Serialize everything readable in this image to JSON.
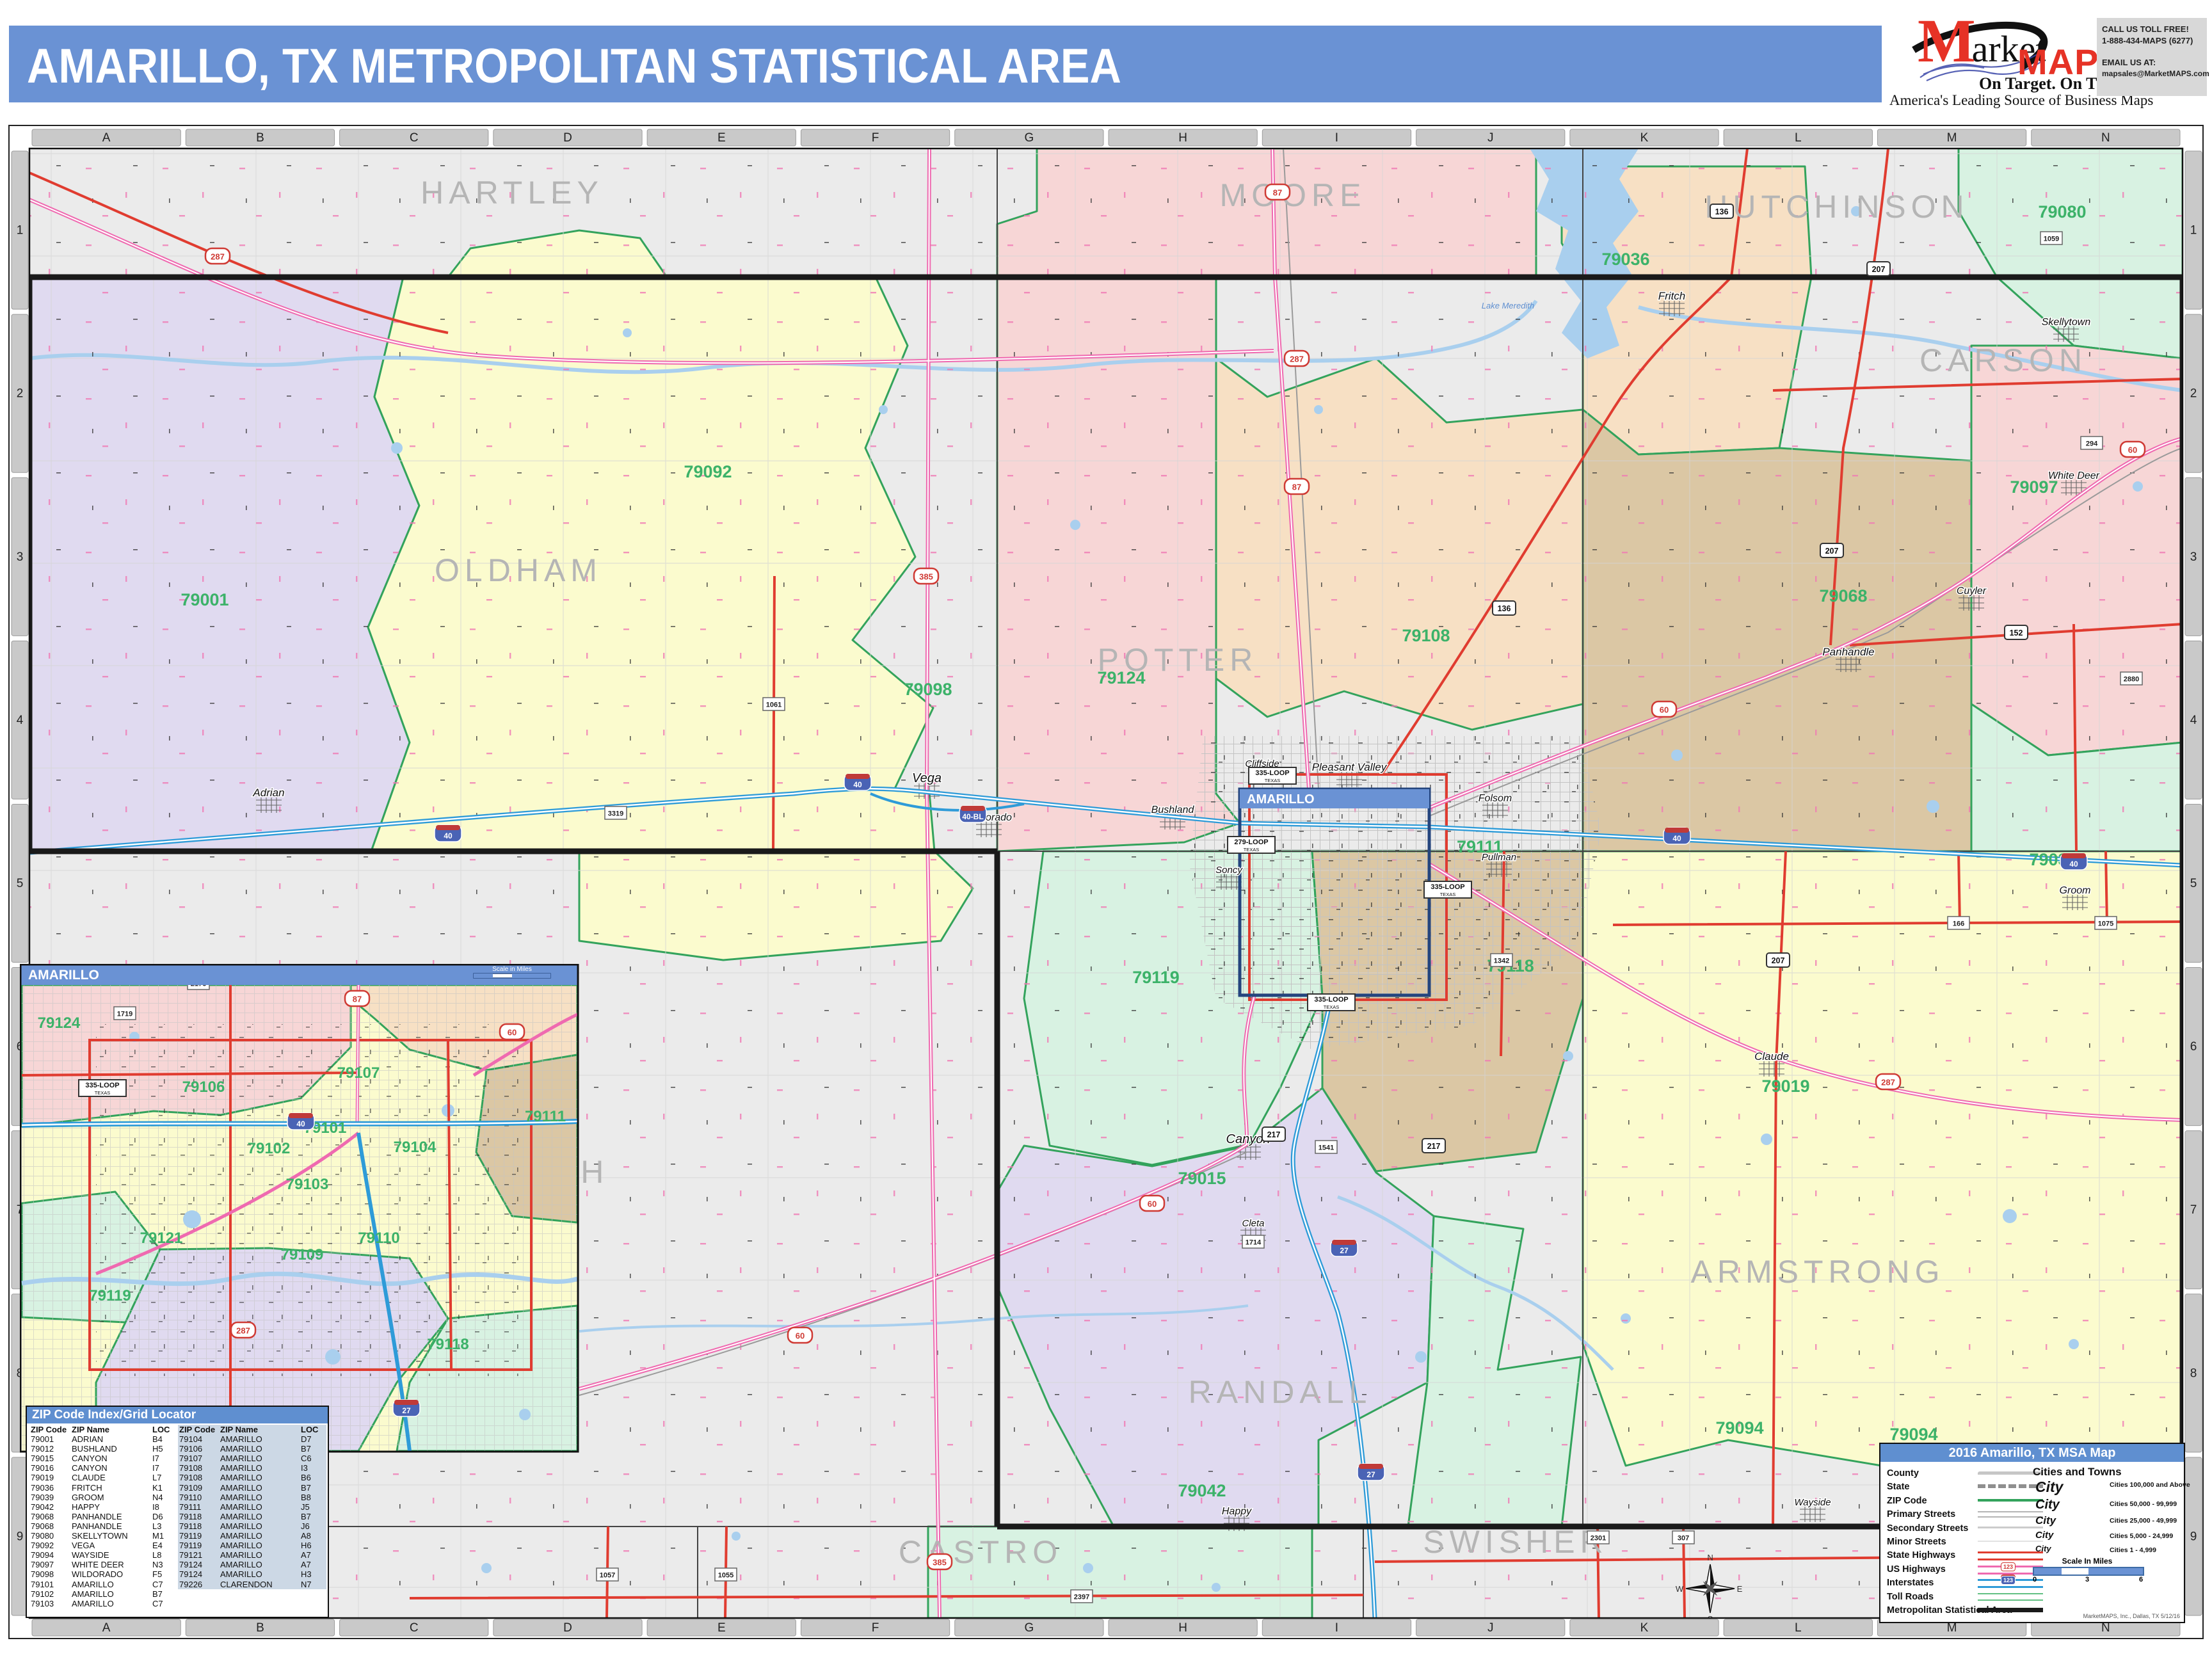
{
  "title": "AMARILLO, TX METROPOLITAN STATISTICAL AREA",
  "logo": {
    "market_initial": "M",
    "market_rest": "arket",
    "maps": "MAPS",
    "tagline": "On Target.  On Time.",
    "subtitle": "America's Leading Source of Business Maps",
    "call_label": "CALL US TOLL FREE!",
    "phone": "1-888-434-MAPS (6277)",
    "email_label": "EMAIL US AT:",
    "email": "mapsales@MarketMAPS.com"
  },
  "colors": {
    "titlebar_blue": "#6a92d4",
    "zip_label_green": "#3cb269",
    "zip_boundary_green": "#33a35c",
    "county_label_gray": "#b5b5b5",
    "state_highway_red": "#e03c30",
    "us_highway_pink": "#ef6ab0",
    "interstate_blue": "#2e9bd8",
    "water_blue": "#a9cfee",
    "msa_boundary_black": "#1a1a1a",
    "table_shade_blue": "#ccd8e5"
  },
  "grid": {
    "columns": [
      "A",
      "B",
      "C",
      "D",
      "E",
      "F",
      "G",
      "H",
      "I",
      "J",
      "K",
      "L",
      "M",
      "N"
    ],
    "rows": [
      "1",
      "2",
      "3",
      "4",
      "5",
      "6",
      "7",
      "8",
      "9"
    ]
  },
  "map": {
    "city_box_label": "AMARILLO",
    "water_label": "Lake Meredith",
    "compass": [
      "N",
      "E",
      "S",
      "W"
    ],
    "counties": [
      [
        "HARTLEY",
        800,
        318
      ],
      [
        "MOORE",
        2020,
        322
      ],
      [
        "HUTCHINSON",
        2870,
        340
      ],
      [
        "OLDHAM",
        810,
        908
      ],
      [
        "POTTER",
        1840,
        1048
      ],
      [
        "CARSON",
        3130,
        580
      ],
      [
        "DEAF SMITH",
        760,
        1848
      ],
      [
        "RANDALL",
        2000,
        2192
      ],
      [
        "ARMSTRONG",
        2840,
        2004
      ],
      [
        "CASTRO",
        1532,
        2442
      ],
      [
        "SWISHER",
        2368,
        2426
      ]
    ],
    "zips": [
      [
        "79001",
        320,
        946
      ],
      [
        "79092",
        1106,
        746
      ],
      [
        "79098",
        1450,
        1086
      ],
      [
        "79124",
        1752,
        1068
      ],
      [
        "79108",
        2228,
        1002
      ],
      [
        "79036",
        2540,
        414
      ],
      [
        "79080",
        3222,
        340
      ],
      [
        "79068",
        2880,
        940
      ],
      [
        "79097",
        3178,
        770
      ],
      [
        "79039",
        3208,
        1352
      ],
      [
        "79019",
        2790,
        1706
      ],
      [
        "79118",
        2360,
        1518
      ],
      [
        "79119",
        1806,
        1536
      ],
      [
        "79015",
        1878,
        1850
      ],
      [
        "79042",
        1878,
        2338
      ],
      [
        "79094",
        2718,
        2240
      ],
      [
        "79094",
        2990,
        2250
      ],
      [
        "79111",
        2312,
        1332
      ]
    ],
    "towns": [
      [
        "Vega",
        1448,
        1222,
        20
      ],
      [
        "Adrian",
        420,
        1244,
        17
      ],
      [
        "Wildorado",
        1545,
        1282,
        16
      ],
      [
        "Bushland",
        1832,
        1270,
        16
      ],
      [
        "Canyon",
        1950,
        1786,
        20
      ],
      [
        "Cleta",
        1958,
        1916,
        15
      ],
      [
        "Happy",
        1932,
        2366,
        16
      ],
      [
        "Panhandle",
        2888,
        1024,
        17
      ],
      [
        "White Deer",
        3240,
        748,
        16
      ],
      [
        "Skellytown",
        3228,
        508,
        16
      ],
      [
        "Cuyler",
        3080,
        928,
        16
      ],
      [
        "Fritch",
        2612,
        468,
        17
      ],
      [
        "Groom",
        3242,
        1396,
        16
      ],
      [
        "Claude",
        2768,
        1656,
        17
      ],
      [
        "Wayside",
        2832,
        2352,
        15
      ],
      [
        "Cliffside",
        1972,
        1198,
        15
      ],
      [
        "Pleasant Valley",
        2108,
        1204,
        17
      ],
      [
        "Folsom",
        2336,
        1252,
        16
      ],
      [
        "Soncy",
        1920,
        1364,
        15
      ],
      [
        "Pullman",
        2342,
        1344,
        15
      ]
    ],
    "shields": [
      [
        "i",
        "40",
        700,
        1302
      ],
      [
        "i",
        "40",
        1340,
        1222
      ],
      [
        "i",
        "40-BL",
        1520,
        1272
      ],
      [
        "i",
        "40",
        2620,
        1306
      ],
      [
        "i",
        "40",
        3240,
        1346
      ],
      [
        "i",
        "27",
        2100,
        1950
      ],
      [
        "i",
        "27",
        2142,
        2300
      ],
      [
        "us",
        "287",
        340,
        400
      ],
      [
        "us",
        "87",
        2026,
        760
      ],
      [
        "us",
        "287",
        2026,
        560
      ],
      [
        "us",
        "87",
        1996,
        300
      ],
      [
        "us",
        "60",
        2600,
        1108
      ],
      [
        "us",
        "60",
        3332,
        702
      ],
      [
        "us",
        "60",
        1800,
        1880
      ],
      [
        "us",
        "287",
        2950,
        1690
      ],
      [
        "us",
        "385",
        1447,
        900
      ],
      [
        "us",
        "385",
        1468,
        2440
      ],
      [
        "us",
        "60",
        1250,
        2086
      ],
      [
        "hwy",
        "136",
        2350,
        950
      ],
      [
        "hwy",
        "136",
        2690,
        330
      ],
      [
        "hwy",
        "152",
        3150,
        988
      ],
      [
        "hwy",
        "207",
        2935,
        420
      ],
      [
        "hwy",
        "207",
        2862,
        860
      ],
      [
        "hwy",
        "207",
        2778,
        1500
      ],
      [
        "hwy",
        "217",
        1990,
        1772
      ],
      [
        "hwy",
        "217",
        2240,
        1790
      ],
      [
        "fm",
        "1061",
        1209,
        1100
      ],
      [
        "fm",
        "1057",
        949,
        2460
      ],
      [
        "fm",
        "1055",
        1134,
        2460
      ],
      [
        "fm",
        "2397",
        1690,
        2494
      ],
      [
        "fm",
        "1714",
        1958,
        1940
      ],
      [
        "fm",
        "1541",
        2072,
        1792
      ],
      [
        "fm",
        "1059",
        3205,
        372
      ],
      [
        "fm",
        "294",
        3268,
        692
      ],
      [
        "fm",
        "2301",
        2497,
        2402
      ],
      [
        "fm",
        "307",
        2630,
        2402
      ],
      [
        "fm",
        "3319",
        962,
        1270
      ],
      [
        "fm",
        "1342",
        2346,
        1500
      ],
      [
        "fm",
        "2880",
        3330,
        1060
      ],
      [
        "fm",
        "166",
        3060,
        1442
      ],
      [
        "fm",
        "1075",
        3290,
        1442
      ],
      [
        "loop",
        "335-LOOP",
        1988,
        1212
      ],
      [
        "loop",
        "335-LOOP",
        2262,
        1390
      ],
      [
        "loop",
        "335-LOOP",
        2080,
        1566
      ],
      [
        "loop",
        "279-LOOP",
        1955,
        1320
      ]
    ]
  },
  "inset": {
    "title": "AMARILLO",
    "scale_label": "Scale in Miles",
    "zips": [
      [
        "79108",
        300,
        1522
      ],
      [
        "79124",
        92,
        1606
      ],
      [
        "79107",
        560,
        1684
      ],
      [
        "79106",
        318,
        1706
      ],
      [
        "79101",
        508,
        1770
      ],
      [
        "79102",
        420,
        1802
      ],
      [
        "79104",
        648,
        1800
      ],
      [
        "79103",
        480,
        1858
      ],
      [
        "79121",
        252,
        1942
      ],
      [
        "79109",
        472,
        1968
      ],
      [
        "79110",
        592,
        1942
      ],
      [
        "79119",
        172,
        2032
      ],
      [
        "79118",
        700,
        2108
      ],
      [
        "79111",
        852,
        1752
      ]
    ],
    "shields": [
      [
        "us",
        "87",
        558,
        1560
      ],
      [
        "fm",
        "1719",
        195,
        1583
      ],
      [
        "fm",
        "2176",
        310,
        1536
      ],
      [
        "i",
        "40",
        470,
        1752
      ],
      [
        "us",
        "60",
        800,
        1612
      ],
      [
        "i",
        "27",
        635,
        2200
      ],
      [
        "loop",
        "335-LOOP",
        160,
        1700
      ],
      [
        "us",
        "287",
        380,
        2078
      ]
    ]
  },
  "zip_table": {
    "title": "ZIP Code Index/Grid Locator",
    "headers": [
      "ZIP Code",
      "ZIP Name",
      "LOC"
    ],
    "left_rows": [
      [
        "79001",
        "ADRIAN",
        "B4"
      ],
      [
        "79012",
        "BUSHLAND",
        "H5"
      ],
      [
        "79015",
        "CANYON",
        "I7"
      ],
      [
        "79016",
        "CANYON",
        "I7"
      ],
      [
        "79019",
        "CLAUDE",
        "L7"
      ],
      [
        "79036",
        "FRITCH",
        "K1"
      ],
      [
        "79039",
        "GROOM",
        "N4"
      ],
      [
        "79042",
        "HAPPY",
        "I8"
      ],
      [
        "79068",
        "PANHANDLE",
        "D6"
      ],
      [
        "79068",
        "PANHANDLE",
        "L3"
      ],
      [
        "79080",
        "SKELLYTOWN",
        "M1"
      ],
      [
        "79092",
        "VEGA",
        "E4"
      ],
      [
        "79094",
        "WAYSIDE",
        "L8"
      ],
      [
        "79097",
        "WHITE DEER",
        "N3"
      ],
      [
        "79098",
        "WILDORADO",
        "F5"
      ],
      [
        "79101",
        "AMARILLO",
        "C7"
      ],
      [
        "79102",
        "AMARILLO",
        "B7"
      ],
      [
        "79103",
        "AMARILLO",
        "C7"
      ]
    ],
    "right_rows": [
      [
        "79104",
        "AMARILLO",
        "D7"
      ],
      [
        "79106",
        "AMARILLO",
        "B7"
      ],
      [
        "79107",
        "AMARILLO",
        "C6"
      ],
      [
        "79108",
        "AMARILLO",
        "I3"
      ],
      [
        "79108",
        "AMARILLO",
        "B6"
      ],
      [
        "79109",
        "AMARILLO",
        "B7"
      ],
      [
        "79110",
        "AMARILLO",
        "B8"
      ],
      [
        "79111",
        "AMARILLO",
        "J5"
      ],
      [
        "79118",
        "AMARILLO",
        "B7"
      ],
      [
        "79118",
        "AMARILLO",
        "J6"
      ],
      [
        "79119",
        "AMARILLO",
        "A8"
      ],
      [
        "79119",
        "AMARILLO",
        "H6"
      ],
      [
        "79121",
        "AMARILLO",
        "A7"
      ],
      [
        "79124",
        "AMARILLO",
        "A7"
      ],
      [
        "79124",
        "AMARILLO",
        "H3"
      ],
      [
        "79226",
        "CLARENDON",
        "N7"
      ]
    ]
  },
  "legend": {
    "title": "2016 Amarillo, TX MSA Map",
    "shield_sample": "123",
    "items": [
      {
        "kind": "county",
        "label": "County"
      },
      {
        "kind": "state",
        "label": "State"
      },
      {
        "kind": "zip",
        "label": "ZIP Code"
      },
      {
        "kind": "primary",
        "label": "Primary Streets"
      },
      {
        "kind": "secondary",
        "label": "Secondary Streets"
      },
      {
        "kind": "minor",
        "label": "Minor Streets"
      },
      {
        "kind": "statehwy",
        "label": "State Highways"
      },
      {
        "kind": "ushwy",
        "label": "US Highways"
      },
      {
        "kind": "interstate",
        "label": "Interstates"
      },
      {
        "kind": "toll",
        "label": "Toll Roads"
      },
      {
        "kind": "msa",
        "label": "Metropolitan Statistical Area"
      }
    ],
    "cities_title": "Cities and Towns",
    "city_classes": [
      {
        "sample": "City",
        "desc": "Cities 100,000 and Above"
      },
      {
        "sample": "City",
        "desc": "Cities 50,000 - 99,999"
      },
      {
        "sample": "City",
        "desc": "Cities 25,000 - 49,999"
      },
      {
        "sample": "City",
        "desc": "Cities 5,000 - 24,999"
      },
      {
        "sample": "City",
        "desc": "Cities 1 - 4,999"
      }
    ],
    "scale_title": "Scale In Miles",
    "scale_ticks": [
      "0",
      "3",
      "6"
    ],
    "credit": "MarketMAPS, Inc., Dallas, TX  5/12/16"
  }
}
